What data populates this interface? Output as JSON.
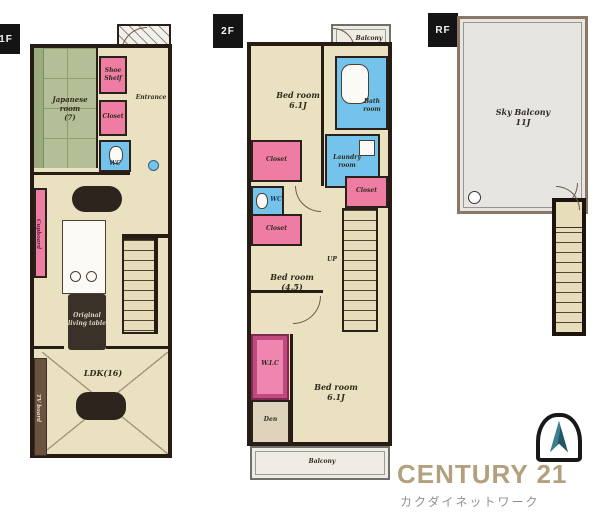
{
  "brand": {
    "name": "CENTURY 21",
    "subtitle": "カクダイネットワーク"
  },
  "palette": {
    "wall": "#261c14",
    "floor": "#eae1c1",
    "tatami_green": "#b4bf97",
    "closet_pink": "#ee7ca3",
    "wet_blue": "#74c3ec",
    "wic_magenta": "#c2497e",
    "balcony_gray": "#e6e5e1",
    "century_gold": "#b2a07f",
    "seal_teal": "#2f6b7c"
  },
  "f1": {
    "badge": "1F",
    "japanese_room": "Japanese room\n(7)",
    "shoe_shelf": "Shoe\nShelf",
    "entrance": "Entrance",
    "closet": "Closet",
    "wc": "WC",
    "cupboard": "Cupboard",
    "table_label": "Original\nliving table",
    "ldk": "LDK(16)",
    "tv_board": "TV board"
  },
  "f2": {
    "badge": "2F",
    "balcony_top": "Balcony",
    "bedroom1": "Bed room\n6.1J",
    "bath": "Bath\nroom",
    "laundry": "Laundry\nroom",
    "closet1": "Closet",
    "wc": "WC",
    "closet2": "Closet",
    "closet3": "Closet",
    "bedroom2": "Bed room\n(4.5)",
    "up": "UP",
    "wic": "W.I.C",
    "den": "Den",
    "bedroom3": "Bed room\n6.1J",
    "balcony_bottom": "Balcony"
  },
  "rf": {
    "badge": "RF",
    "sky_balcony": "Sky Balcony\n11J"
  }
}
